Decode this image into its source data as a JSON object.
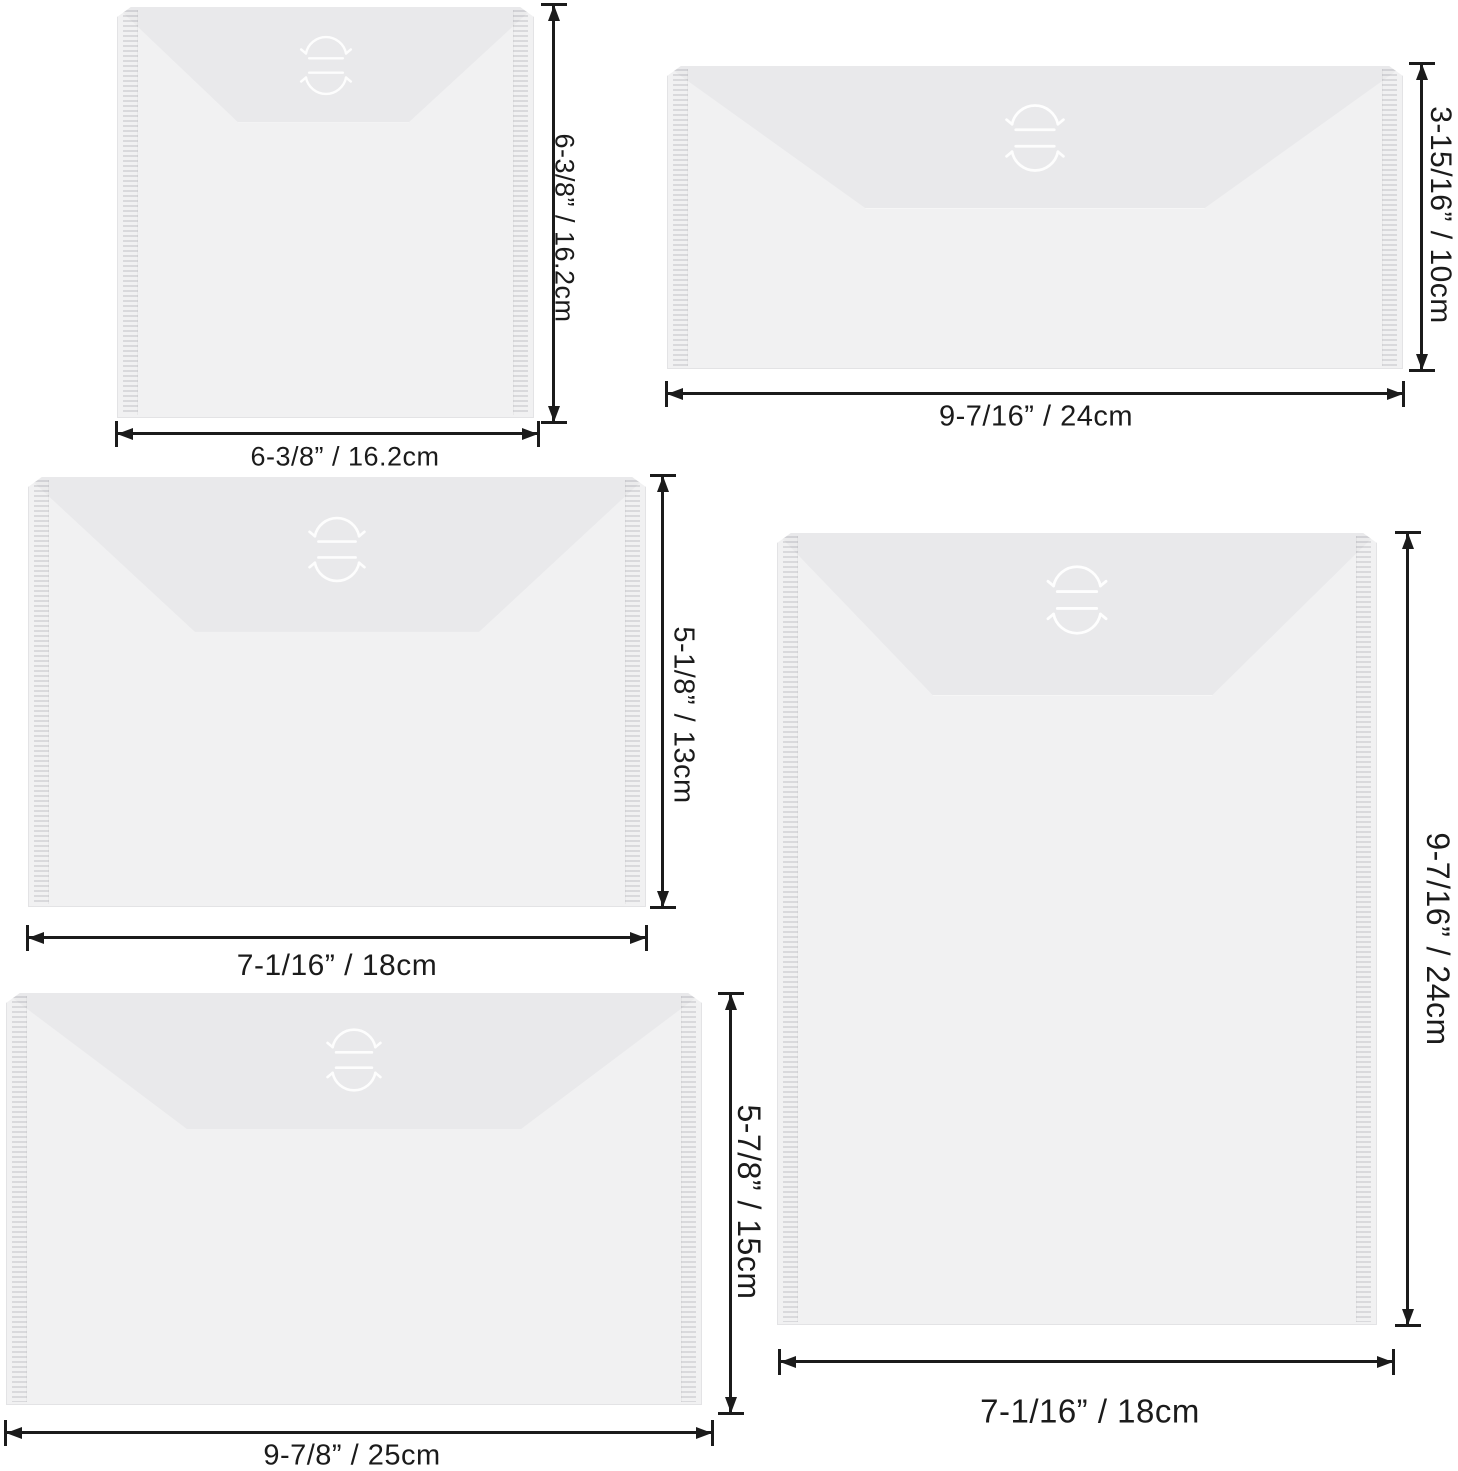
{
  "diagram": {
    "description": "Size diagram of five translucent poly envelope pockets with hook-and-loop flap closures",
    "background_color": "#ffffff",
    "colors": {
      "envelope_body": "#f1f1f2",
      "envelope_flap": "#e9e9eb",
      "seam_highlight": "#ffffff",
      "dimension_lines": "#1b1b1b"
    },
    "icons": {
      "closure": "flap-closure-arrows-icon",
      "side_seal": "welded-seal-strip"
    }
  },
  "envelopes": [
    {
      "name": "square-pocket",
      "width_label": "6-3/8” / 16.2cm",
      "height_label": "6-3/8” / 16.2cm",
      "width_in": "6-3/8",
      "width_cm": 16.2,
      "height_in": "6-3/8",
      "height_cm": 16.2
    },
    {
      "name": "slim-wide-pocket",
      "width_label": "9-7/16” / 24cm",
      "height_label": "3-15/16” / 10cm",
      "width_in": "9-7/16",
      "width_cm": 24,
      "height_in": "3-15/16",
      "height_cm": 10
    },
    {
      "name": "medium-landscape-pocket",
      "width_label": "7-1/16” / 18cm",
      "height_label": "5-1/8” / 13cm",
      "width_in": "7-1/16",
      "width_cm": 18,
      "height_in": "5-1/8",
      "height_cm": 13
    },
    {
      "name": "large-landscape-pocket",
      "width_label": "9-7/8” / 25cm",
      "height_label": "5-7/8” / 15cm",
      "width_in": "9-7/8",
      "width_cm": 25,
      "height_in": "5-7/8",
      "height_cm": 15
    },
    {
      "name": "tall-portrait-pocket",
      "width_label": "7-1/16” / 18cm",
      "height_label": "9-7/16” / 24cm",
      "width_in": "7-1/16",
      "width_cm": 18,
      "height_in": "9-7/16",
      "height_cm": 24
    }
  ]
}
